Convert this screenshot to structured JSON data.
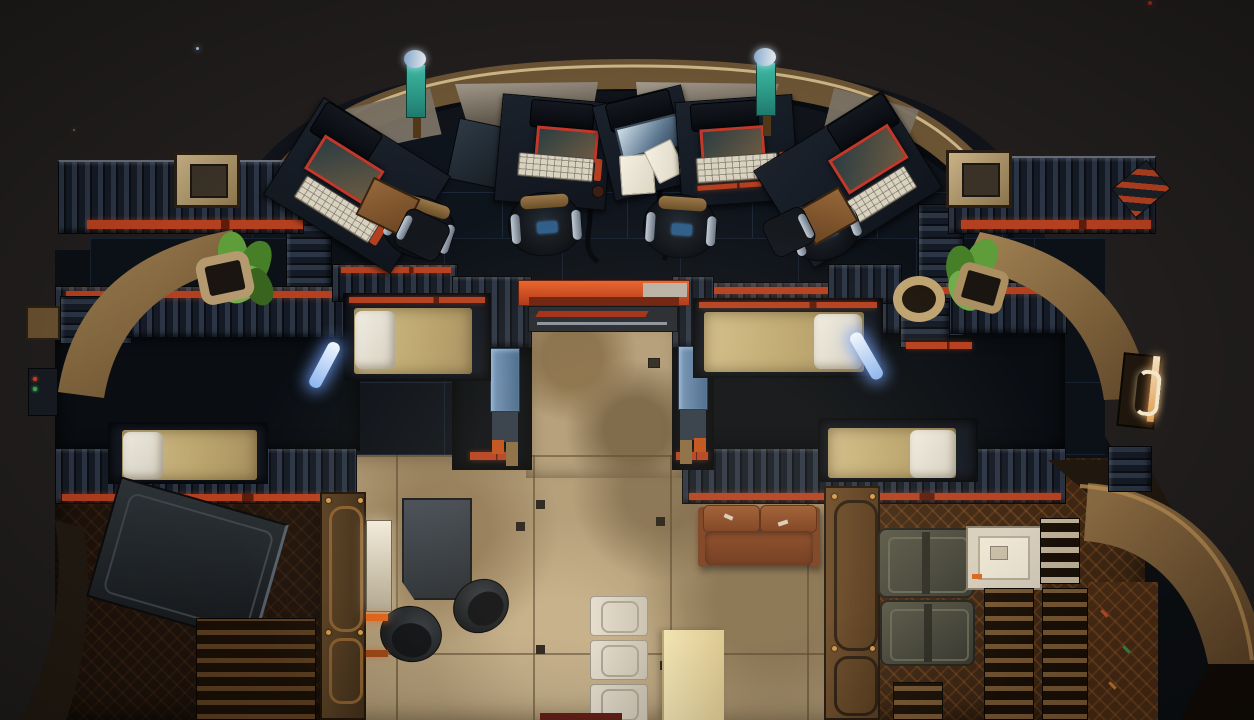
{
  "meta": {
    "app": "game-viewport",
    "scene": "Top-down spaceship interior deck view",
    "width_px": 1254,
    "height_px": 720,
    "visible_text": "none"
  },
  "palette": {
    "sky": "#211e1d",
    "shipDark": "#0c0f13",
    "domeDark": "#10141a",
    "brass": "#6b5434",
    "brassLight": "#d8c190",
    "navyFloor": "#0c1118",
    "red": "#b5401f",
    "orange": "#d94a1c",
    "screenRed": "#c0392b",
    "tanFloor": "#b09a76",
    "mattress": "#c8b27e",
    "pillow": "#ebe6da",
    "glowBlue": "#cfe4ff",
    "teal": "#2fa08c",
    "leather": "#8a4a28",
    "rust": "#3a2312",
    "olive": "#50503f",
    "cream": "#d8cfbe",
    "pale": "#ead9a4",
    "ladderWhite": "#ddd6c9",
    "pillarBlue": "#5d82a8",
    "wood": "#8a5e33"
  },
  "stars": [
    {
      "x": 196,
      "y": 47,
      "size": 3,
      "color": "#aecdf0"
    },
    {
      "x": 73,
      "y": 129,
      "size": 2,
      "color": "#8a6a4a"
    },
    {
      "x": 618,
      "y": 64,
      "size": 3,
      "color": "#6b513c"
    },
    {
      "x": 1102,
      "y": 165,
      "size": 3,
      "color": "#e0903f"
    },
    {
      "x": 1148,
      "y": 1,
      "size": 4,
      "color": "#a03020"
    }
  ],
  "objects": [
    {
      "name": "cockpit-console-left",
      "kind": "workstation"
    },
    {
      "name": "cockpit-console-center-left",
      "kind": "workstation"
    },
    {
      "name": "cockpit-console-center",
      "kind": "nav-terminal-with-papers"
    },
    {
      "name": "cockpit-console-center-right",
      "kind": "workstation"
    },
    {
      "name": "cockpit-console-right",
      "kind": "workstation"
    },
    {
      "name": "pilot-chair",
      "count": 4
    },
    {
      "name": "signal-beacon",
      "count": 2
    },
    {
      "name": "bunk-bed",
      "count": 4
    },
    {
      "name": "reading-light-tube",
      "count": 2
    },
    {
      "name": "potted-plant",
      "count": 2
    },
    {
      "name": "corridor-doorway",
      "kind": "red-header"
    },
    {
      "name": "leather-couch",
      "count": 1
    },
    {
      "name": "mess-table-dark",
      "count": 1
    },
    {
      "name": "bar-stool",
      "count": 2
    },
    {
      "name": "floor-ladder",
      "count": 1
    },
    {
      "name": "side-table-pale",
      "count": 1
    },
    {
      "name": "storage-trunk",
      "count": 2
    },
    {
      "name": "supply-station",
      "count": 1
    },
    {
      "name": "cargo-crate-angled",
      "count": 1
    },
    {
      "name": "hull-door-handle",
      "count": 1
    }
  ]
}
